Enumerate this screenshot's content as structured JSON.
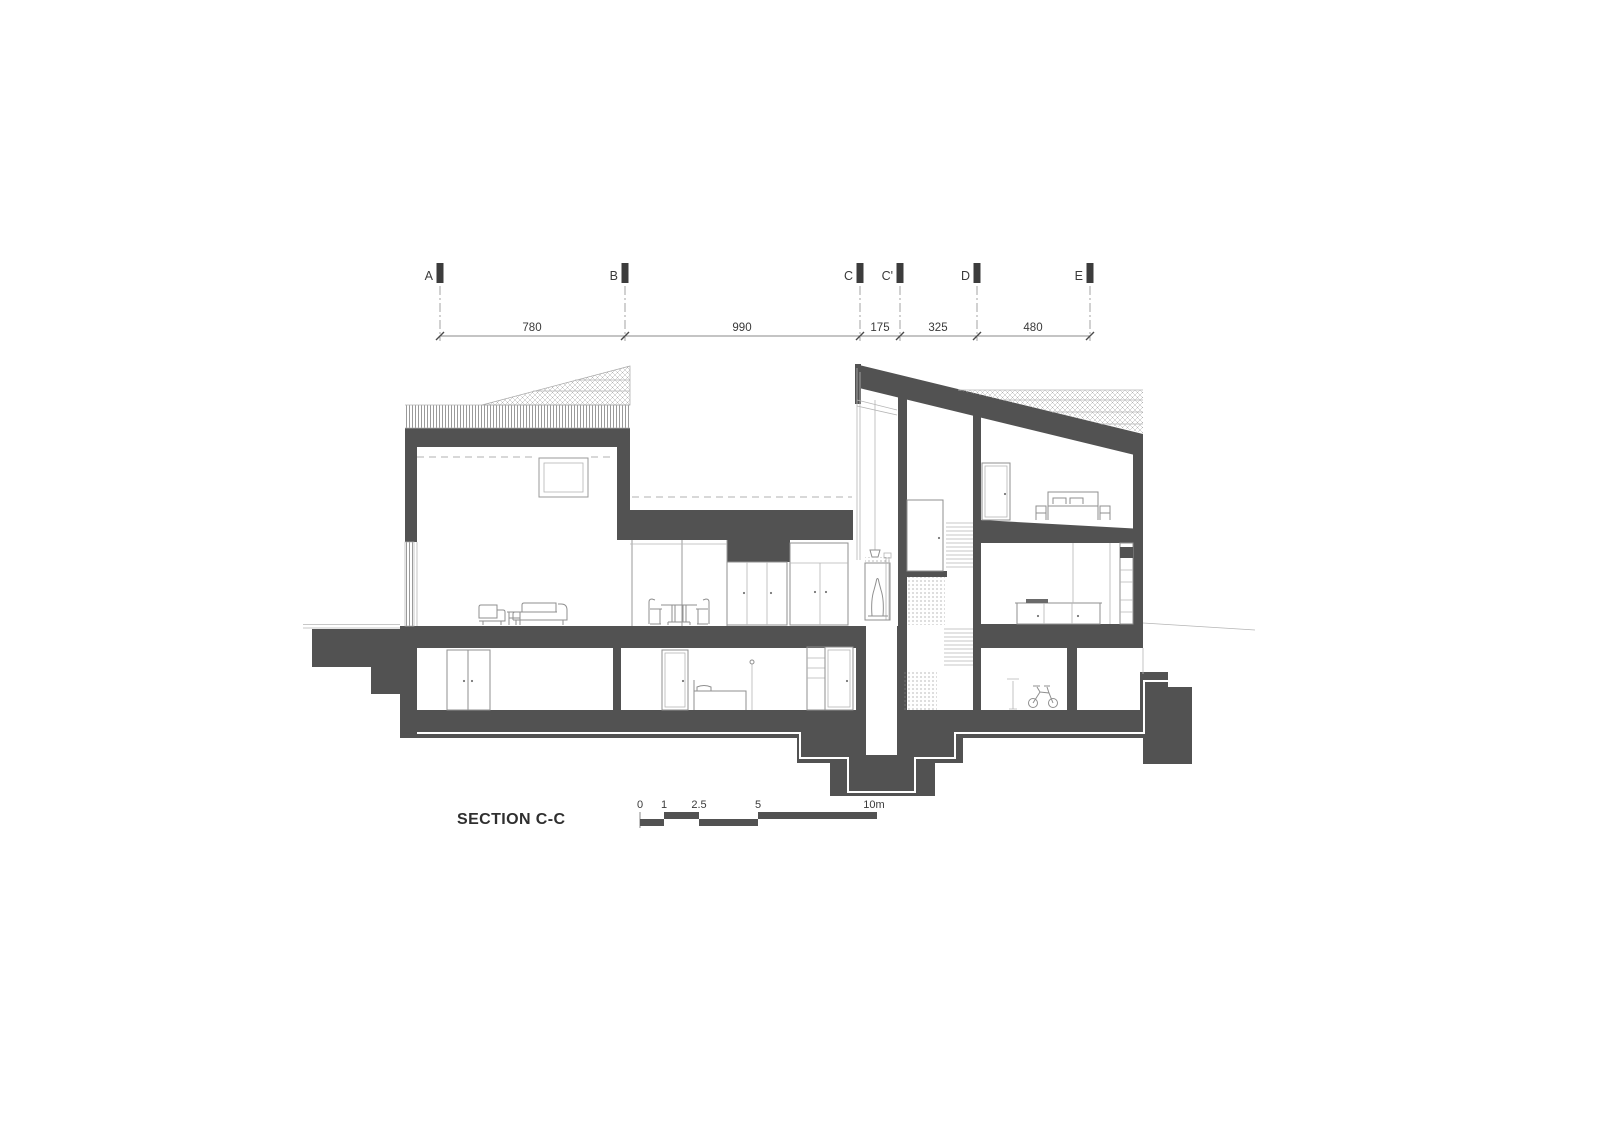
{
  "drawing": {
    "title": "SECTION C-C",
    "grid": {
      "labels": [
        "A",
        "B",
        "C",
        "C'",
        "D",
        "E"
      ]
    },
    "dimensions": {
      "values": [
        "780",
        "990",
        "175",
        "325",
        "480"
      ]
    },
    "scale_bar": {
      "labels": [
        "0",
        "1",
        "2.5",
        "5",
        "10m"
      ],
      "unit": "m"
    },
    "colors": {
      "poche": "#525252",
      "flag": "#3c3c3c",
      "text": "#3a3a3a",
      "thin_line": "#9a9a9a",
      "furniture_line": "#8f8f8f",
      "hatch_line": "#b3b3b3",
      "dash_line": "#b0b0b0",
      "background": "#ffffff"
    }
  }
}
